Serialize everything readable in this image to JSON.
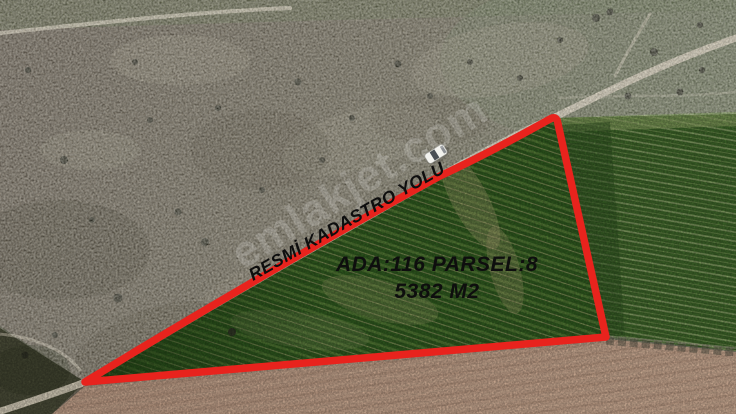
{
  "scene": {
    "description": "Aerial drone photo of a triangular farmland parcel outlined in red, bordered by a dirt cadastral road, green crop fields and a pink plowed field"
  },
  "annotations": {
    "road_label": "RESMİ KADASTRO YOLU",
    "parcel": {
      "line1": "ADA:116 PARSEL:8",
      "line2": "5382 M2"
    },
    "watermark": "emlakjet.com"
  },
  "colors": {
    "parcel_outline": "#e8231d",
    "label_text": "#0e0e0e",
    "watermark": "#ffffff",
    "scrub_base": "#6e6559",
    "scrub_green": "#7b8068",
    "scrub_dark_corner": "#4a4c38",
    "field_green_parcel": "#2f5a1f",
    "field_green_adjacent": "#3d6529",
    "plowed_pink": "#c2a28b",
    "road": "#dbd3bf",
    "car_body": "#f2f2ee"
  }
}
